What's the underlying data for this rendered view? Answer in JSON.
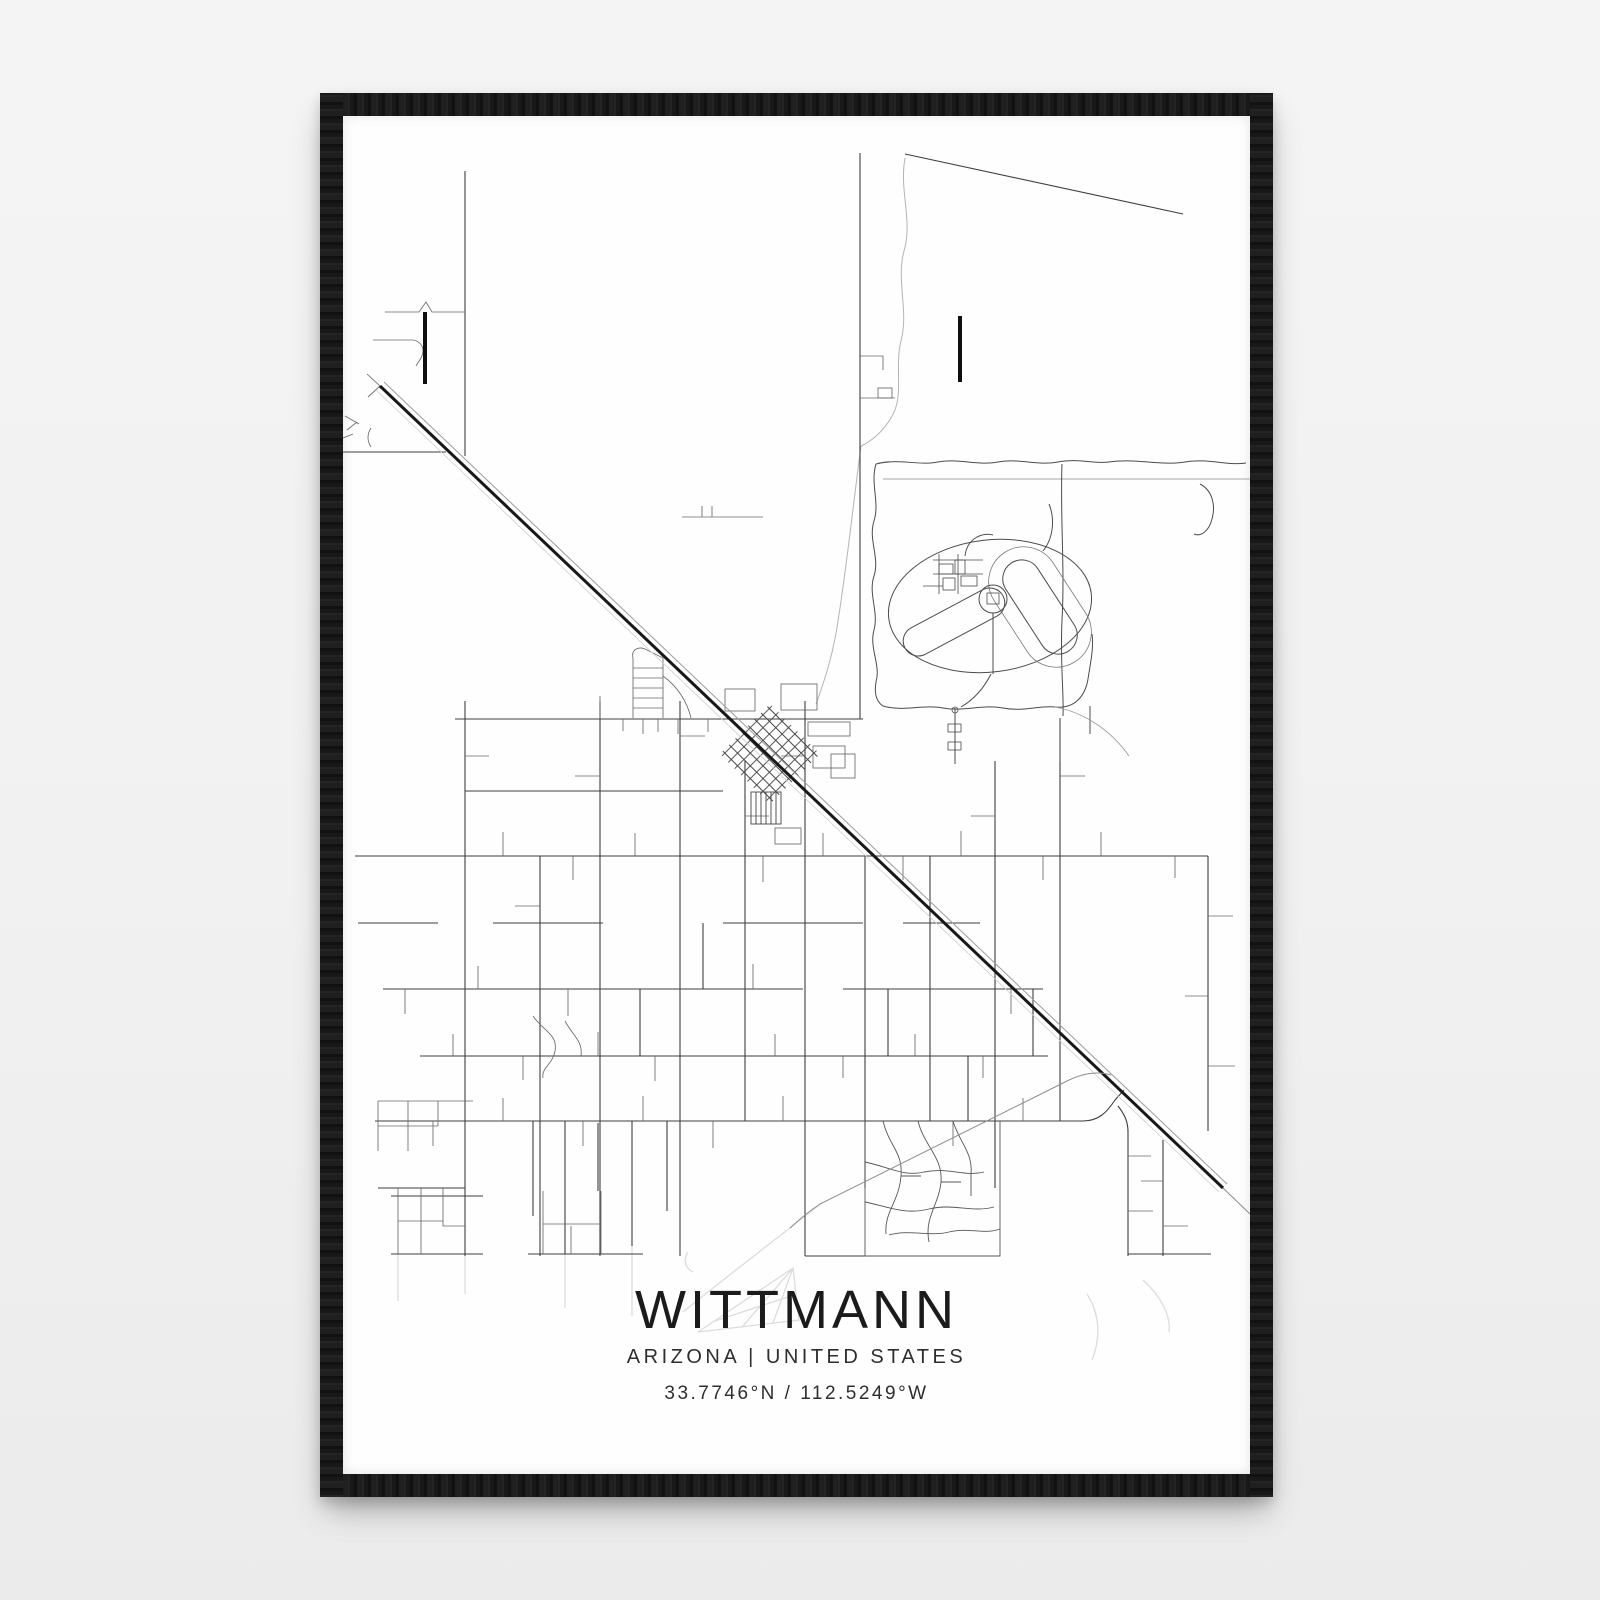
{
  "poster": {
    "title": "WITTMANN",
    "subtitle": "ARIZONA | UNITED STATES",
    "coordinates": "33.7746°N / 112.5249°W"
  },
  "colors": {
    "background": "#f0f0f0",
    "frame": "#151515",
    "paper": "#fefefe",
    "streets": "#3f3f3f",
    "highway": "#181818",
    "railroad": "#9c9c9c",
    "creek": "#b4b4b4",
    "text": "#1b1b1b"
  },
  "map": {
    "features": [
      "diagonal-highway",
      "railroad-line",
      "rural-street-grid",
      "town-center-diamond-blocks",
      "racetrack-complex",
      "creek",
      "curvy-subdivision",
      "watermark-shapes"
    ]
  }
}
